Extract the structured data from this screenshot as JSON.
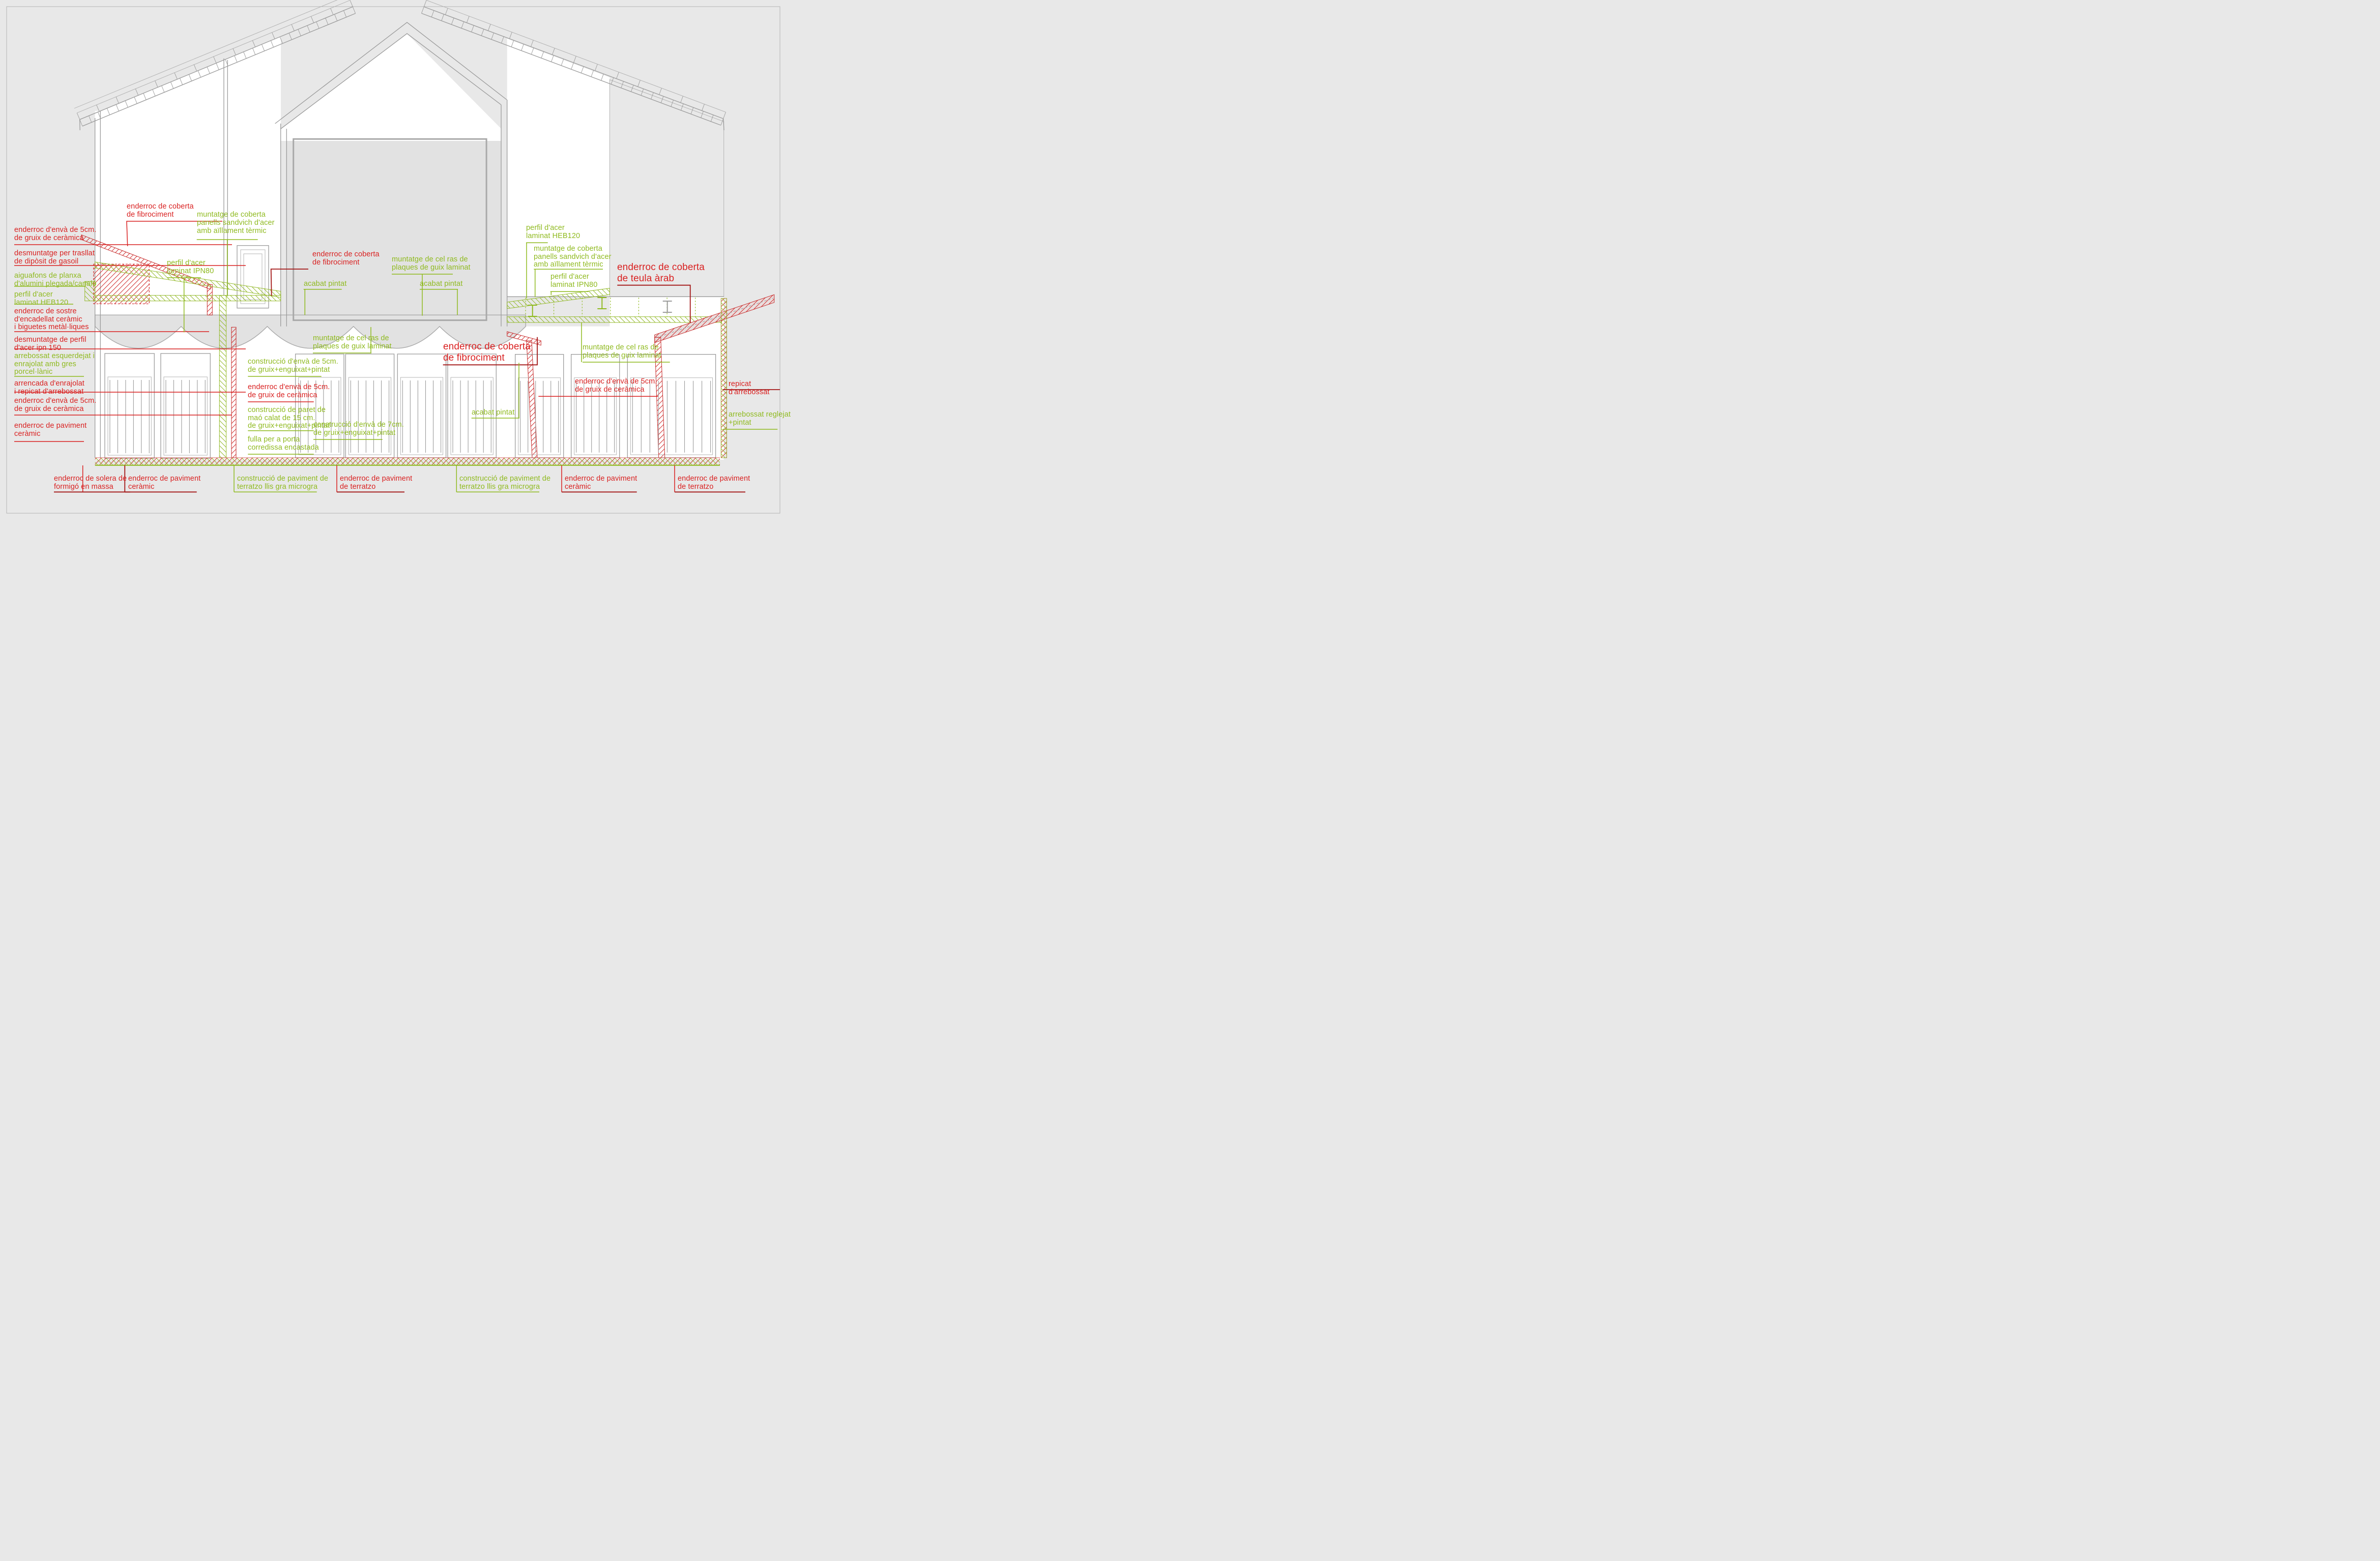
{
  "meta": {
    "drawing_type": "architectural building section with demolition and construction annotations",
    "language": "Catalan"
  },
  "colors": {
    "demolition_red": "#d92121",
    "leader_dark_red": "#a31616",
    "construction_green": "#8fba1f",
    "line_gray": "#9b9b9b",
    "background": "#e8e8e8"
  },
  "labels": {
    "left": [
      {
        "id": "enderroc-enva-5cm-1",
        "color": "red",
        "text": "enderroc d'envà de 5cm.\nde gruix de ceràmica"
      },
      {
        "id": "desmuntatge-diposit",
        "color": "red",
        "text": "desmuntatge per trasllat\nde dipòsit de gasoil"
      },
      {
        "id": "aiguafons-planxa",
        "color": "green",
        "text": "aiguafons de planxa\nd'alumini plegada/canaló"
      },
      {
        "id": "perfil-heb120-left",
        "color": "green",
        "text": "perfil  d'acer\nlaminat HEB120"
      },
      {
        "id": "enderroc-sostre",
        "color": "red",
        "text": "enderroc de sostre\nd'encadellat ceràmic\ni biguetes metàl·liques"
      },
      {
        "id": "desmuntatge-ipn150",
        "color": "red",
        "text": "desmuntatge de perfil\nd'acer ipn 150"
      },
      {
        "id": "arrebossat-gres",
        "color": "green",
        "text": "arrebossat esquerdejat i\nenrajolat amb gres\nporcel·lànic"
      },
      {
        "id": "arrencada-enrajolat",
        "color": "red",
        "text": "arrencada d'enrajolat\ni repicat d'arrebossat"
      },
      {
        "id": "enderroc-enva-5cm-2",
        "color": "red",
        "text": "enderroc d'envà de 5cm.\nde gruix de ceràmica"
      },
      {
        "id": "enderroc-paviment-ceramic-left",
        "color": "red",
        "text": "enderroc de paviment\nceràmic"
      }
    ],
    "top": [
      {
        "id": "enderroc-coberta-fibrociment-top",
        "color": "red",
        "text": "enderroc de coberta\nde fibrociment"
      },
      {
        "id": "muntatge-coberta-sandvich-top",
        "color": "green",
        "text": "muntatge de coberta\npanells sandvich d'acer\namb aïllament tèrmic"
      },
      {
        "id": "perfil-ipn80-top",
        "color": "green",
        "text": "perfil  d'acer\nlaminat IPN80"
      }
    ],
    "center": [
      {
        "id": "enderroc-coberta-fibrociment-mid",
        "color": "red",
        "text": "enderroc de coberta\nde fibrociment"
      },
      {
        "id": "muntatge-celras-mid",
        "color": "green",
        "text": "muntatge de cel ras de\nplaques de guix laminat"
      },
      {
        "id": "acabat-pintat-1",
        "color": "green",
        "text": "acabat pintat"
      },
      {
        "id": "acabat-pintat-2",
        "color": "green",
        "text": "acabat pintat"
      },
      {
        "id": "muntatge-celras-left",
        "color": "green",
        "text": "muntatge de cel ras de\nplaques de guix laminat"
      },
      {
        "id": "enderroc-coberta-fibrociment-big",
        "color": "red",
        "text": "enderroc de coberta\nde fibrociment"
      },
      {
        "id": "acabat-pintat-3",
        "color": "green",
        "text": "acabat pintat"
      },
      {
        "id": "construccio-enva-7cm",
        "color": "green",
        "text": "construcció d'envà de 7cm.\nde gruix+enguixat+pintat"
      },
      {
        "id": "construccio-enva-5cm",
        "color": "green",
        "text": "construcció d'envà de 5cm.\nde gruix+enguixat+pintat"
      },
      {
        "id": "enderroc-enva-5cm-mid",
        "color": "red",
        "text": "enderroc d'envà de 5cm.\nde gruix de ceràmica"
      },
      {
        "id": "construccio-paret-mao",
        "color": "green",
        "text": "construcció de paret de\nmaó calat de 15 cm.\nde gruix+enguixat+pintat"
      },
      {
        "id": "fulla-porta-corredissa",
        "color": "green",
        "text": "fulla per a porta\ncorredissa encastada"
      }
    ],
    "right": [
      {
        "id": "perfil-heb120-right",
        "color": "green",
        "text": "perfil  d'acer\nlaminat HEB120"
      },
      {
        "id": "muntatge-coberta-sandvich-right",
        "color": "green",
        "text": "muntatge de coberta\npanells sandvich d'acer\namb aïllament tèrmic"
      },
      {
        "id": "perfil-ipn80-right",
        "color": "green",
        "text": "perfil  d'acer\nlaminat IPN80"
      },
      {
        "id": "enderroc-teula-arab",
        "color": "red",
        "text": "enderroc de coberta\nde teula àrab"
      },
      {
        "id": "muntatge-celras-right",
        "color": "green",
        "text": "muntatge de cel ras de\nplaques de guix laminat"
      },
      {
        "id": "enderroc-enva-5cm-right",
        "color": "red",
        "text": "enderroc d'envà de 5cm.\nde gruix de ceràmica"
      },
      {
        "id": "repicat-arrebossat",
        "color": "red",
        "text": "repicat d'arrebossat"
      },
      {
        "id": "arrebossat-reglejat",
        "color": "green",
        "text": "arrebossat reglejat\n+pintat"
      }
    ],
    "bottom": [
      {
        "id": "enderroc-solera",
        "color": "red",
        "text": "enderroc de solera de\nformigó en massa"
      },
      {
        "id": "enderroc-paviment-ceramic-b1",
        "color": "red",
        "text": "enderroc de paviment\nceràmic"
      },
      {
        "id": "construccio-terratzo-1",
        "color": "green",
        "text": "construcció de paviment de\nterratzo llis gra microgra"
      },
      {
        "id": "enderroc-terratzo-1",
        "color": "red",
        "text": "enderroc de paviment\nde terratzo"
      },
      {
        "id": "construccio-terratzo-2",
        "color": "green",
        "text": "construcció de paviment de\nterratzo llis gra microgra"
      },
      {
        "id": "enderroc-paviment-ceramic-b2",
        "color": "red",
        "text": "enderroc de paviment\nceràmic"
      },
      {
        "id": "enderroc-terratzo-2",
        "color": "red",
        "text": "enderroc de paviment\nde terratzo"
      }
    ]
  }
}
